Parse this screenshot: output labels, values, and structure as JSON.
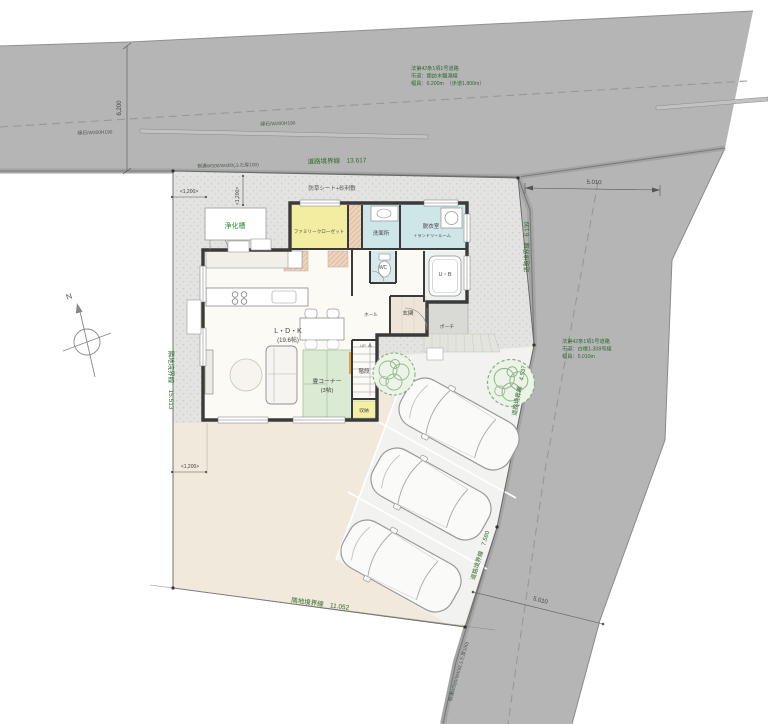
{
  "palette": {
    "road": "#b5b5b5",
    "road_edge_band": "#a4a4a4",
    "road_edge_line": "#7a7a7a",
    "gravel": "#e3e3e1",
    "garden_beige": "#f0e9dc",
    "parking_pale": "#f2f2f0",
    "wall": "#3a3a3a",
    "room_yellow": "#f3eda1",
    "room_cyan": "#cfe6e8",
    "room_green": "#dbead3",
    "closet_peach": "#edd3bd",
    "stair_orange": "#e8a33d",
    "tree_green": "#8fb489",
    "annotation_green": "#2f6b2f",
    "annotation_gray": "#4a5a4a"
  },
  "notes": [
    {
      "name": "road-note-top",
      "x": 411,
      "y": 70,
      "size": 5.2,
      "color": "#2f6b2f",
      "lines": [
        "法第42条1項1号道路",
        "市道：諏訪木鋸淵線",
        "幅員：6.200m　（歩道1.800m）"
      ]
    },
    {
      "name": "road-note-right",
      "x": 562,
      "y": 343,
      "size": 5.2,
      "color": "#2f6b2f",
      "lines": [
        "法第42条1項1号道路",
        "市道：白根1-308号線",
        "幅員：5.010m"
      ]
    }
  ],
  "labels": [
    {
      "name": "curb-label-left",
      "text": "縁石/W200H190",
      "x": 95,
      "y": 134,
      "r": -2,
      "s": 4.8,
      "c": "#4a5a4a"
    },
    {
      "name": "curb-label-right",
      "text": "縁石/W200H190",
      "x": 278,
      "y": 125,
      "r": -2,
      "s": 4.8,
      "c": "#4a5a4a"
    },
    {
      "name": "gutter-label-top",
      "text": "側溝W500/W400(ふた厚100)",
      "x": 228,
      "y": 167,
      "r": -1.5,
      "s": 4.8,
      "c": "#4a5a4a"
    },
    {
      "name": "road-boundary-top-label",
      "text": "道路境界線　13.617",
      "x": 337,
      "y": 163,
      "r": -1.5,
      "s": 6.5,
      "c": "#2f6b2f"
    },
    {
      "name": "weed-sheet-gravel-label",
      "text": "防草シート+砂利敷",
      "x": 332,
      "y": 190,
      "r": 0,
      "s": 5.5,
      "c": "#555555"
    },
    {
      "name": "dim-5010-top",
      "text": "5.010",
      "x": 594,
      "y": 184,
      "r": 2,
      "s": 6,
      "c": "#444444"
    },
    {
      "name": "dim-6200",
      "text": "6,200",
      "x": 121,
      "y": 108,
      "r": -90,
      "s": 6,
      "c": "#444444"
    },
    {
      "name": "dim-1200-top-left",
      "text": "<1,200>",
      "x": 189,
      "y": 193,
      "r": 0,
      "s": 5,
      "c": "#444444"
    },
    {
      "name": "dim-1200-top-mid",
      "text": "<1,200>",
      "x": 239,
      "y": 196,
      "r": -90,
      "s": 5,
      "c": "#444444"
    },
    {
      "name": "dim-1200-bottom-left",
      "text": "<1,200>",
      "x": 190,
      "y": 468,
      "r": 0,
      "s": 5,
      "c": "#444444"
    },
    {
      "name": "neighbor-boundary-left-label",
      "text": "隣地境界線　15.513",
      "x": 169,
      "y": 380,
      "r": 90,
      "s": 6.5,
      "c": "#2f6b2f"
    },
    {
      "name": "road-boundary-right-label",
      "text": "道路境界線　6.139",
      "x": 529,
      "y": 247,
      "r": -90,
      "s": 6,
      "c": "#2f6b2f"
    },
    {
      "name": "road-boundary-mid-label",
      "text": "道路境界線　4.537",
      "x": 521,
      "y": 391,
      "r": -79,
      "s": 6,
      "c": "#2f6b2f"
    },
    {
      "name": "road-boundary-low-label",
      "text": "道路境界線　7.580",
      "x": 482,
      "y": 556,
      "r": -73,
      "s": 6,
      "c": "#2f6b2f"
    },
    {
      "name": "dim-5010-bottom",
      "text": "5.010",
      "x": 540,
      "y": 602,
      "r": 14,
      "s": 6,
      "c": "#444444"
    },
    {
      "name": "neighbor-boundary-bottom-label",
      "text": "隣地境界線　11.052",
      "x": 320,
      "y": 606,
      "r": 7.5,
      "s": 6.5,
      "c": "#2f6b2f"
    },
    {
      "name": "gutter-label-right",
      "text": "側溝W500/W400(ふた厚100)",
      "x": 460,
      "y": 672,
      "r": -74,
      "s": 4.8,
      "c": "#4a5a4a"
    },
    {
      "name": "septic-tank-label",
      "text": "浄化槽",
      "x": 235,
      "y": 228,
      "r": 0,
      "s": 7,
      "c": "#2e8b2e"
    },
    {
      "name": "north-letter",
      "text": "N",
      "x": 70,
      "y": 299,
      "r": -20,
      "s": 8,
      "c": "#555555"
    }
  ],
  "rooms": [
    {
      "name": "room-label-family-closet",
      "text": "ファミリークローゼット",
      "x": 319,
      "y": 233,
      "s": 4.6,
      "c": "#444444"
    },
    {
      "name": "room-label-senmenjo",
      "text": "洗面所",
      "x": 381,
      "y": 235,
      "s": 5.5,
      "c": "#444444"
    },
    {
      "name": "room-label-datsuishitsu",
      "text": "脱衣室",
      "x": 431,
      "y": 228,
      "s": 5.5,
      "c": "#444444"
    },
    {
      "name": "room-label-laundry",
      "text": "＋ランドリールーム",
      "x": 432,
      "y": 237,
      "s": 4.2,
      "c": "#444444"
    },
    {
      "name": "room-label-wc",
      "text": "WC",
      "x": 383,
      "y": 269,
      "s": 5,
      "c": "#444444"
    },
    {
      "name": "room-label-ub",
      "text": "U・B",
      "x": 445,
      "y": 276,
      "s": 5.5,
      "c": "#444444"
    },
    {
      "name": "room-label-hall",
      "text": "ホール",
      "x": 371,
      "y": 316,
      "s": 4.6,
      "c": "#444444"
    },
    {
      "name": "room-label-genkan",
      "text": "玄関",
      "x": 408,
      "y": 315,
      "s": 5.5,
      "c": "#444444"
    },
    {
      "name": "room-label-porch",
      "text": "ポーチ",
      "x": 447,
      "y": 328,
      "s": 4.8,
      "c": "#444444"
    },
    {
      "name": "room-label-ldk",
      "text": "L・D・K",
      "x": 288,
      "y": 333,
      "s": 7,
      "c": "#444444"
    },
    {
      "name": "room-label-ldk-size",
      "text": "(19.6帖)",
      "x": 288,
      "y": 342,
      "s": 6,
      "c": "#444444"
    },
    {
      "name": "room-label-tatami",
      "text": "畳コーナー",
      "x": 327,
      "y": 383,
      "s": 5.8,
      "c": "#444444"
    },
    {
      "name": "room-label-tatami-size",
      "text": "(3帖)",
      "x": 327,
      "y": 392,
      "s": 5.8,
      "c": "#444444"
    },
    {
      "name": "room-label-stairs",
      "text": "階段",
      "x": 364,
      "y": 373,
      "s": 5.5,
      "c": "#444444"
    },
    {
      "name": "room-label-up",
      "text": "UP",
      "x": 363,
      "y": 347,
      "s": 4,
      "c": "#666666"
    },
    {
      "name": "room-label-storage",
      "text": "収納",
      "x": 364,
      "y": 412,
      "s": 4.8,
      "c": "#444444"
    }
  ]
}
